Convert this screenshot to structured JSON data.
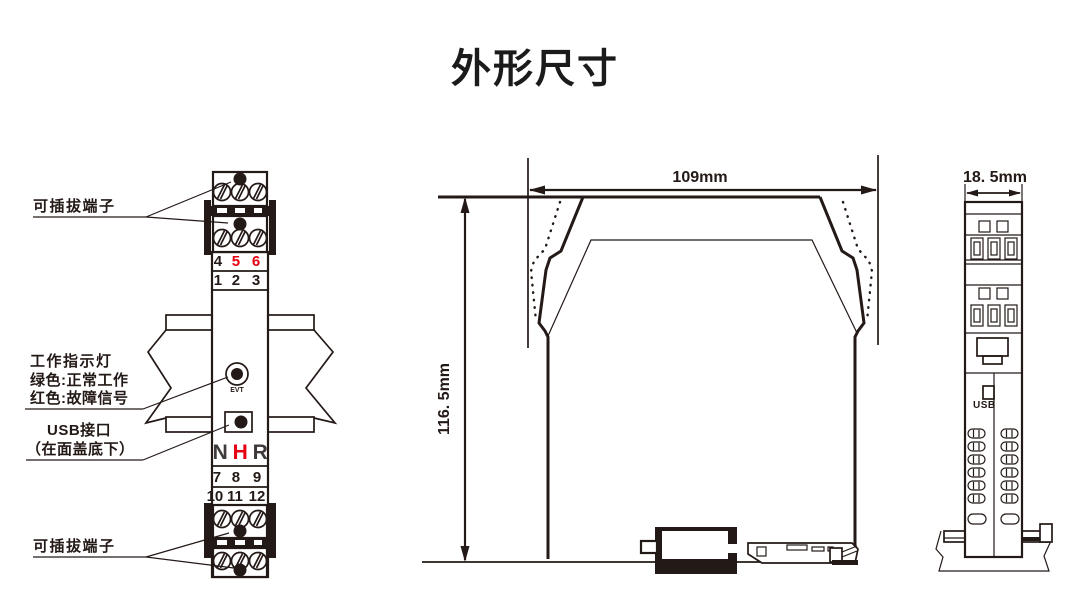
{
  "title": "外形尺寸",
  "colors": {
    "ink": "#231916",
    "red": "#e60012",
    "logo_dark": "#3f3a39"
  },
  "front_view": {
    "label_pluggable_top": "可插拔端子",
    "label_indicator": [
      "工作指示灯",
      "绿色:正常工作",
      "红色:故障信号"
    ],
    "label_usb": [
      "USB接口",
      "（在面盖底下）"
    ],
    "label_pluggable_bottom": "可插拔端子",
    "led_label": "EVT",
    "logo": [
      "N",
      "H",
      "R"
    ],
    "terminals": {
      "row_456": [
        "4",
        "5",
        "6"
      ],
      "row_123": [
        "1",
        "2",
        "3"
      ],
      "row_789": [
        "7",
        "8",
        "9"
      ],
      "row_101112": [
        "10",
        "11",
        "12"
      ]
    }
  },
  "side_view": {
    "width_label": "109mm",
    "height_label": "116. 5mm"
  },
  "end_view": {
    "width_label": "18. 5mm",
    "usb_label": "USB"
  }
}
